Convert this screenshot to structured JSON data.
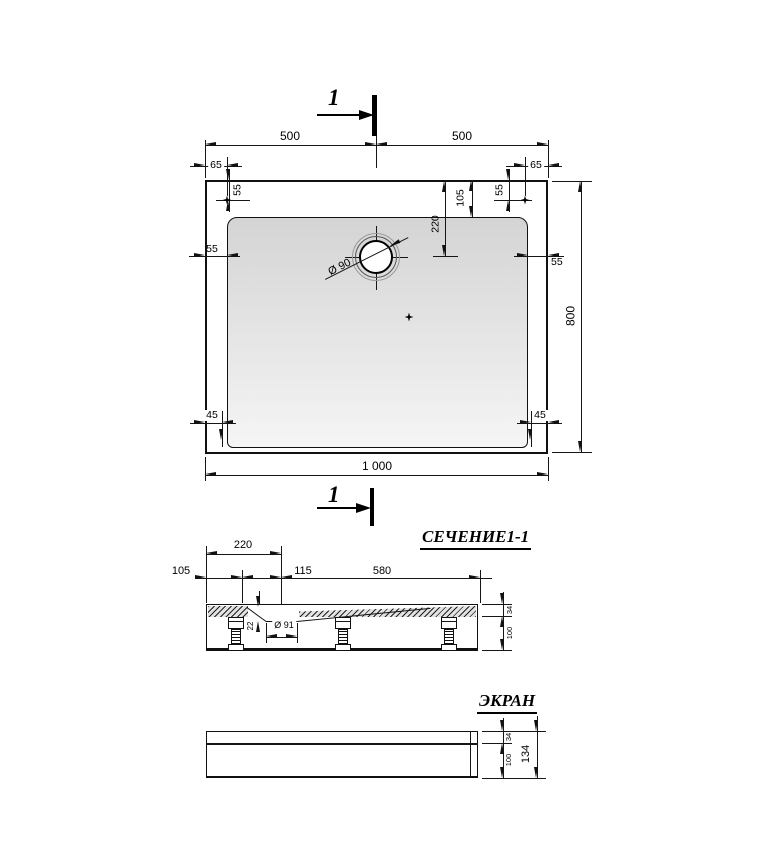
{
  "cut_mark": {
    "label": "1"
  },
  "plan": {
    "dims": {
      "half_width_left": "500",
      "half_width_right": "500",
      "corner_offset_left": "65",
      "corner_offset_right": "65",
      "mount_inset_top_left": "55",
      "mount_inset_top_right": "55",
      "rim_top": "105",
      "drain_offset": "220",
      "rim_left": "55",
      "rim_right": "55",
      "panel_inset_left": "45",
      "panel_inset_right": "45",
      "overall_width": "1 000",
      "overall_depth": "800",
      "drain_diameter": "Ø 90"
    }
  },
  "section": {
    "title": "СЕЧЕНИЕ1-1",
    "dims": {
      "edge_to_basin": "105",
      "edge_to_drain": "220",
      "basin_to_drain": "115",
      "drain_to_edge": "580",
      "basin_depth": "22",
      "drain_hole": "Ø 91",
      "rim_height": "34",
      "leg_height": "100"
    }
  },
  "screen": {
    "title": "ЭКРАН",
    "dims": {
      "top_band": "34",
      "bottom_band": "100",
      "total_height": "134"
    }
  }
}
